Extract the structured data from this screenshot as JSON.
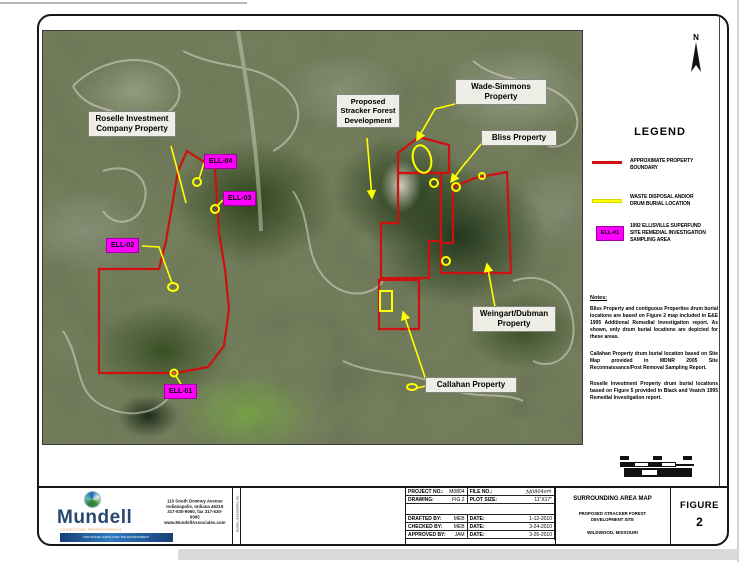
{
  "map": {
    "north_label": "N",
    "colors": {
      "property_boundary": "#cf1010",
      "waste_disposal": "#ffff00",
      "sampling_area": "#ff00ff"
    },
    "labels": {
      "roselle": {
        "line1": "Roselle Investment",
        "line2": "Company Property"
      },
      "stracker": {
        "line1": "Proposed",
        "line2": "Stracker Forest",
        "line3": "Development"
      },
      "wade": {
        "line1": "Wade-Simmons",
        "line2": "Property"
      },
      "bliss": {
        "line1": "Bliss Property"
      },
      "weingart": {
        "line1": "Weingart/Dubman",
        "line2": "Property"
      },
      "callahan": {
        "line1": "Callahan Property"
      },
      "ell04": "ELL-04",
      "ell03": "ELL-03",
      "ell02": "ELL-02",
      "ell01": "ELL-01"
    }
  },
  "legend": {
    "title": "LEGEND",
    "item1": {
      "label": "APPROXIMATE PROPERTY BOUNDARY"
    },
    "item2": {
      "label_line1": "WASTE DISPOSAL AND/OR",
      "label_line2": "DRUM BURIAL LOCATION"
    },
    "item3": {
      "box_text": "ELL-#1",
      "label_line1": "1992 ELLISVILLE SUPERFUND",
      "label_line2": "SITE REMEDIAL INVESTIGATION",
      "label_line3": "SAMPLING AREA"
    }
  },
  "notes": {
    "heading": "Notes:",
    "p1": "Bliss Property and contiguous Properties drum burial locations are based on Figure 2 map included in E&E 1995 Additional Remedial Investigation report. As shown, only drum burial locations are depicted for these areas.",
    "p2": "Callahan Property drum burial location based on Site Map provided in MDNR 2005 Site Reconnaissance/Post Removal Sampling Report.",
    "p3": "Roselle Investment Property drum burial locations based on Figure 5 provided in Black and Veatch 1995 Remedial Investigation report."
  },
  "title_block": {
    "company": {
      "name": "Mundell",
      "tagline": "CONSULTING PROFESSIONALS",
      "banner": "FOR WATER, EARTH AND THE ENVIRONMENT",
      "address_line1": "110 South Downey Avenue",
      "address_line2": "Indianapolis, Indiana 46219",
      "address_line3": "317-630-9060, fax 317-630-9065",
      "address_line4": "www.MundellAssociates.com",
      "side_note": "MUNDELL & ASSOCIATES, INC."
    },
    "project": {
      "project_no_label": "PROJECT NO.:",
      "project_no": "M0804",
      "file_no_label": "FILE NO.:",
      "file_no": "M0804am",
      "drawing_label": "DRAWING:",
      "drawing": "FIG 2",
      "plot_size_label": "PLOT SIZE:",
      "plot_size": "11\"X17\"",
      "drafted_label": "DRAFTED BY:",
      "drafted": "MEB",
      "drafted_date_label": "DATE:",
      "drafted_date": "1-12-2010",
      "checked_label": "CHECKED BY:",
      "checked": "MEB",
      "checked_date_label": "DATE:",
      "checked_date": "3-24-2010",
      "approved_label": "APPROVED BY:",
      "approved": "JAM",
      "approved_date_label": "DATE:",
      "approved_date": "3-26-2010"
    },
    "sheet": {
      "title": "SURROUNDING AREA MAP",
      "subtitle1": "PROPOSED STRACKER FOREST",
      "subtitle2": "DEVELOPMENT SITE",
      "location": "WILDWOOD, MISSOURI",
      "figure_label": "FIGURE",
      "figure_number": "2"
    }
  }
}
